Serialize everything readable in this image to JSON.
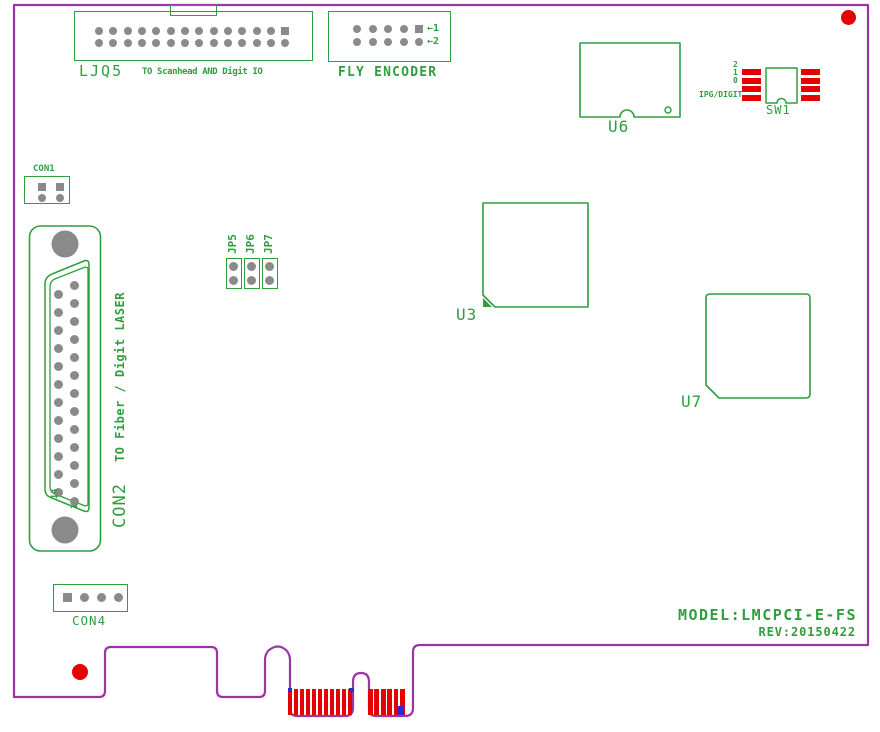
{
  "title_block": {
    "model": "MODEL:LMCPCI-E-FS",
    "revision": "REV:20150422"
  },
  "connectors": {
    "ljq5": {
      "label": "LJQ5",
      "description": "TO Scanhead AND Digit IO",
      "rows": {
        "top": {
          "count": 14,
          "square": "last"
        },
        "bottom": {
          "count": 14,
          "square": "none"
        }
      }
    },
    "fly_encoder": {
      "label": "FLY ENCODER",
      "pin1_arrow": "←1",
      "pin2_arrow": "←2",
      "rows": {
        "top": {
          "count": 5,
          "square": "last"
        },
        "bottom": {
          "count": 5,
          "square": "none"
        }
      }
    },
    "con1": {
      "label": "CON1",
      "rows": {
        "top": {
          "count": 2,
          "square": "all"
        },
        "bottom": {
          "count": 2,
          "square": "none"
        }
      }
    },
    "con2": {
      "label": "CON2",
      "description": "TO Fiber / Digit LASER",
      "pin14_label": "14",
      "pin1_label": "1",
      "columns": {
        "right": {
          "count": 13,
          "square": "none"
        },
        "left": {
          "count": 12,
          "square": "none"
        }
      }
    },
    "con4": {
      "label": "CON4",
      "rows": {
        "single": {
          "count": 4,
          "square": "first"
        }
      }
    },
    "jumpers": [
      {
        "label": "JP5",
        "pins": {
          "count": 2,
          "square": "none"
        }
      },
      {
        "label": "JP6",
        "pins": {
          "count": 2,
          "square": "none"
        }
      },
      {
        "label": "JP7",
        "pins": {
          "count": 2,
          "square": "none"
        }
      }
    ]
  },
  "ics": {
    "u6": {
      "label": "U6"
    },
    "u3": {
      "label": "U3"
    },
    "u7": {
      "label": "U7"
    }
  },
  "dip_switch": {
    "label": "SW1",
    "mode_label": "IPG/DIGIT",
    "positions": [
      "2",
      "1",
      "0"
    ],
    "pads_left": {
      "count": 4
    },
    "pads_right": {
      "count": 4
    }
  },
  "edge_connector": {
    "fingers_left": {
      "count": 11
    },
    "fingers_right": {
      "count": 6
    }
  },
  "colors": {
    "board_outline": "#9a35a2",
    "silkscreen_green": "#2f9e3f",
    "pin_gray": "#8a8a8a",
    "highlight_red": "#e60000",
    "mark_blue": "#2b2bd5"
  }
}
